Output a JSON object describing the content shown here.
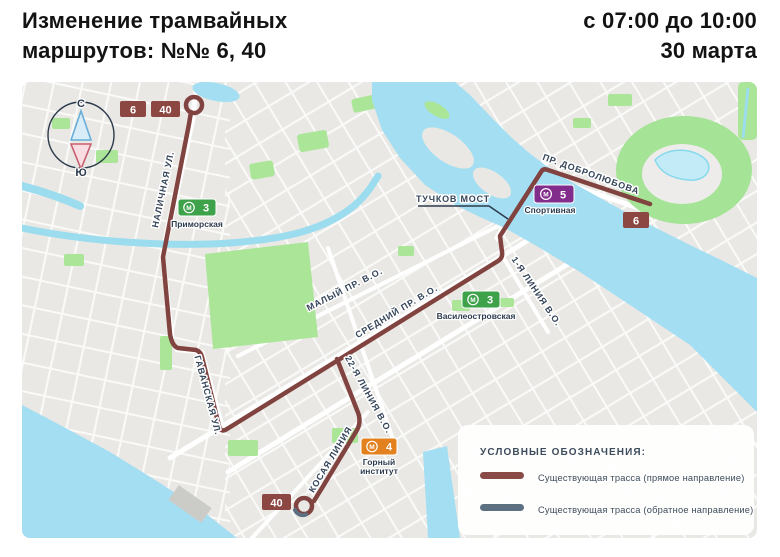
{
  "header": {
    "title_line1": "Изменение трамвайных",
    "title_line2": "маршрутов: №№ 6, 40",
    "schedule_line1": "с 07:00 до 10:00",
    "schedule_line2": "30 марта"
  },
  "map": {
    "compass": {
      "north_label": "С",
      "south_label": "Ю"
    },
    "tram_badges": [
      {
        "id": "route-6-start",
        "label": "6"
      },
      {
        "id": "route-40-start",
        "label": "40"
      },
      {
        "id": "route-6-end",
        "label": "6"
      },
      {
        "id": "route-40-end",
        "label": "40"
      }
    ],
    "street_labels": [
      {
        "label": "НАЛИЧНАЯ УЛ."
      },
      {
        "label": "ГАВАНСКАЯ УЛ."
      },
      {
        "label": "МАЛЫЙ ПР. В.О."
      },
      {
        "label": "СРЕДНИЙ ПР. В.О."
      },
      {
        "label": "22-Я ЛИНИЯ В.О."
      },
      {
        "label": "КОСАЯ ЛИНИЯ"
      },
      {
        "label": "1-Я ЛИНИЯ В.О."
      },
      {
        "label": "ПР. ДОБРОЛЮБОВА"
      }
    ],
    "bridge_callout": {
      "label": "ТУЧКОВ МОСТ"
    },
    "metro_logo_letter": "М",
    "metro_stations": [
      {
        "line": "3",
        "name": "Приморская",
        "color": "#3ea24b"
      },
      {
        "line": "3",
        "name": "Василеостровская",
        "color": "#3ea24b"
      },
      {
        "line": "5",
        "name": "Спортивная",
        "color": "#822c8c"
      },
      {
        "line": "4",
        "name_line1": "Горный",
        "name_line2": "институт",
        "color": "#e2811d"
      }
    ],
    "colors": {
      "route_forward": "#80433f",
      "route_reverse": "#5d7081",
      "tram_badge": "#8c4743",
      "water": "#a3def2",
      "park": "#abe598"
    }
  },
  "legend": {
    "title": "УСЛОВНЫЕ ОБОЗНАЧЕНИЯ:",
    "items": [
      {
        "label": "Существующая трасса (прямое направление)",
        "color": "#8a4a45"
      },
      {
        "label": "Существующая трасса (обратное направление)",
        "color": "#5d7081"
      }
    ]
  }
}
